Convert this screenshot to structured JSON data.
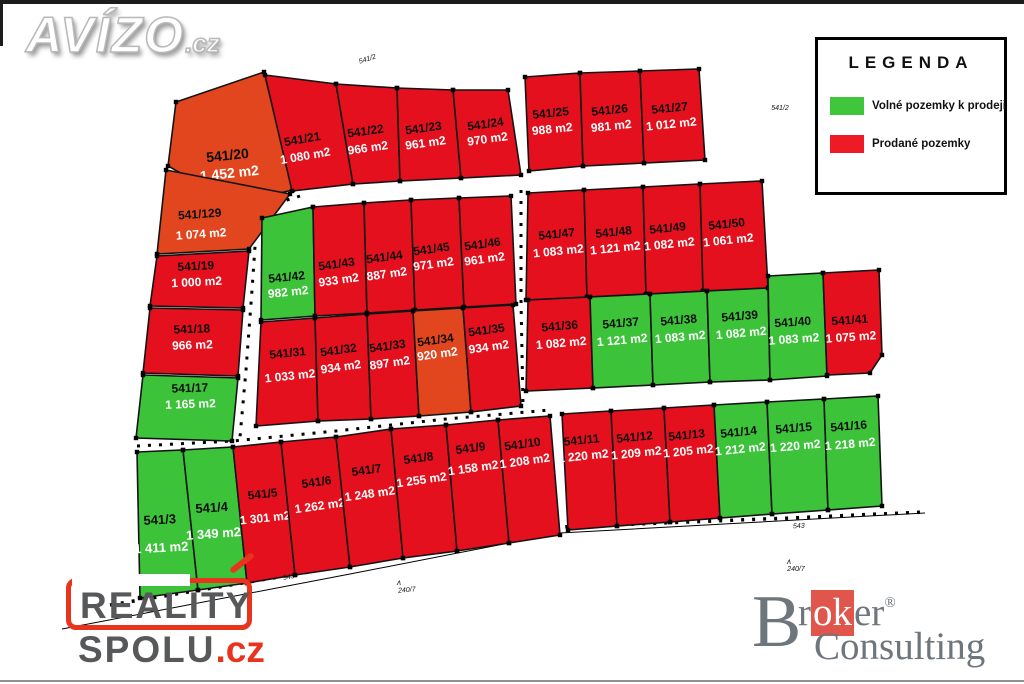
{
  "branding": {
    "avizo": {
      "text": "AVÍZO",
      "suffix": ".cz"
    },
    "reality_spolu": {
      "line1": "REALITY",
      "line2": "SPOLU",
      "suffix": ".cz"
    },
    "broker": {
      "b": "B",
      "pre": "r",
      "ok": "ok",
      "post": "er",
      "reg": "®",
      "line2": "Consulting"
    }
  },
  "legend": {
    "title": "LEGENDA",
    "items": [
      {
        "label": "Volné pozemky k prodeji",
        "color": "#3fc63c",
        "status": "available"
      },
      {
        "label": "Prodané pozemky",
        "color": "#ed1b24",
        "status": "sold"
      }
    ]
  },
  "colors": {
    "sold": "#e5101e",
    "sold_alt": "#e2461e",
    "available": "#3cc33a",
    "stroke": "#141414",
    "number_text": "#0d0d0d",
    "area_text": "#ffffff"
  },
  "parcels": [
    {
      "n": "541/20",
      "a": "1 452 m2",
      "s": "sold",
      "alt": true,
      "pts": "176,102 264,72 293,190 234,203 168,166",
      "lx": 228,
      "ly": 160,
      "dy": 18,
      "rot": -6,
      "fs": 14
    },
    {
      "n": "541/129",
      "a": "1 074 m2",
      "s": "sold",
      "alt": true,
      "pts": "166,170 290,194 249,249 157,254",
      "lx": 200,
      "ly": 218,
      "dy": 20,
      "rot": -4,
      "fs": 12
    },
    {
      "n": "541/19",
      "a": "1 000 m2",
      "s": "sold",
      "pts": "157,256 249,251 243,308 150,306",
      "lx": 196,
      "ly": 270,
      "dy": 16,
      "rot": -3,
      "fs": 12
    },
    {
      "n": "541/18",
      "a": "966 m2",
      "s": "sold",
      "pts": "150,308 243,310 238,376 143,373",
      "lx": 192,
      "ly": 333,
      "dy": 16,
      "rot": -2,
      "fs": 12
    },
    {
      "n": "541/17",
      "a": "1 165 m2",
      "s": "available",
      "pts": "143,375 238,378 232,441 136,438",
      "lx": 190,
      "ly": 392,
      "dy": 16,
      "rot": -2,
      "fs": 12
    },
    {
      "n": "541/21",
      "a": "1 080 m2",
      "s": "sold",
      "pts": "265,75 336,84 353,184 292,191",
      "lx": 303,
      "ly": 143,
      "dy": 17,
      "rot": -10,
      "fs": 12
    },
    {
      "n": "541/22",
      "a": "966 m2",
      "s": "sold",
      "pts": "336,84 397,88 400,181 353,184",
      "lx": 366,
      "ly": 135,
      "dy": 17,
      "rot": -8,
      "fs": 12
    },
    {
      "n": "541/23",
      "a": "961 m2",
      "s": "sold",
      "pts": "397,88 453,90 461,178 400,181",
      "lx": 424,
      "ly": 132,
      "dy": 15,
      "rot": -8,
      "fs": 12
    },
    {
      "n": "541/24",
      "a": "970 m2",
      "s": "sold",
      "pts": "453,90 508,90 521,175 461,178",
      "lx": 486,
      "ly": 128,
      "dy": 15,
      "rot": -8,
      "fs": 12
    },
    {
      "n": "541/25",
      "a": "988 m2",
      "s": "sold",
      "pts": "525,77 580,73 583,166 529,171",
      "lx": 551,
      "ly": 117,
      "dy": 16,
      "rot": -6,
      "fs": 12
    },
    {
      "n": "541/26",
      "a": "981 m2",
      "s": "sold",
      "pts": "580,73 640,71 644,163 583,166",
      "lx": 610,
      "ly": 114,
      "dy": 16,
      "rot": -6,
      "fs": 12
    },
    {
      "n": "541/27",
      "a": "1 012 m2",
      "s": "sold",
      "pts": "640,71 699,69 705,160 644,163",
      "lx": 670,
      "ly": 112,
      "dy": 16,
      "rot": -6,
      "fs": 12
    },
    {
      "n": "541/42",
      "a": "982 m2",
      "s": "available",
      "pts": "262,218 313,207 315,316 261,320",
      "lx": 287,
      "ly": 281,
      "dy": 15,
      "rot": -6,
      "fs": 12
    },
    {
      "n": "541/43",
      "a": "933 m2",
      "s": "sold",
      "pts": "313,207 364,203 367,313 315,316",
      "lx": 337,
      "ly": 268,
      "dy": 16,
      "rot": -8,
      "fs": 12
    },
    {
      "n": "541/44",
      "a": "887 m2",
      "s": "sold",
      "pts": "364,203 411,200 415,310 367,313",
      "lx": 385,
      "ly": 261,
      "dy": 17,
      "rot": -8,
      "fs": 12
    },
    {
      "n": "541/45",
      "a": "971 m2",
      "s": "sold",
      "pts": "411,200 459,198 464,307 415,310",
      "lx": 432,
      "ly": 253,
      "dy": 15,
      "rot": -8,
      "fs": 12
    },
    {
      "n": "541/46",
      "a": "961 m2",
      "s": "sold",
      "pts": "459,198 511,196 516,304 464,307",
      "lx": 483,
      "ly": 248,
      "dy": 15,
      "rot": -8,
      "fs": 12
    },
    {
      "n": "541/47",
      "a": "1 083 m2",
      "s": "sold",
      "pts": "528,193 584,190 587,297 526,300",
      "lx": 557,
      "ly": 238,
      "dy": 17,
      "rot": -6,
      "fs": 12
    },
    {
      "n": "541/48",
      "a": "1 121 m2",
      "s": "sold",
      "pts": "584,190 643,187 646,294 587,297",
      "lx": 614,
      "ly": 236,
      "dy": 16,
      "rot": -6,
      "fs": 12
    },
    {
      "n": "541/49",
      "a": "1 082 m2",
      "s": "sold",
      "pts": "643,187 700,184 703,291 646,294",
      "lx": 668,
      "ly": 232,
      "dy": 16,
      "rot": -6,
      "fs": 12
    },
    {
      "n": "541/50",
      "a": "1 061 m2",
      "s": "sold",
      "pts": "700,184 762,181 768,288 703,291",
      "lx": 727,
      "ly": 228,
      "dy": 16,
      "rot": -6,
      "fs": 12
    },
    {
      "n": "541/31",
      "a": "1 033 m2",
      "s": "sold",
      "pts": "261,322 315,318 318,421 256,426",
      "lx": 288,
      "ly": 357,
      "dy": 23,
      "rot": -6,
      "fs": 12
    },
    {
      "n": "541/32",
      "a": "934 m2",
      "s": "sold",
      "pts": "315,318 367,314 371,419 318,421",
      "lx": 339,
      "ly": 354,
      "dy": 17,
      "rot": -8,
      "fs": 12
    },
    {
      "n": "541/33",
      "a": "897 m2",
      "s": "sold",
      "pts": "367,314 413,311 419,416 371,419",
      "lx": 388,
      "ly": 350,
      "dy": 17,
      "rot": -8,
      "fs": 12
    },
    {
      "n": "541/34",
      "a": "920 m2",
      "s": "sold",
      "alt": true,
      "pts": "413,311 463,308 471,412 419,416",
      "lx": 436,
      "ly": 344,
      "dy": 14,
      "rot": -8,
      "fs": 12
    },
    {
      "n": "541/35",
      "a": "934 m2",
      "s": "sold",
      "pts": "463,308 513,305 521,406 471,412",
      "lx": 487,
      "ly": 334,
      "dy": 17,
      "rot": -8,
      "fs": 12
    },
    {
      "n": "541/36",
      "a": "1 082 m2",
      "s": "sold",
      "pts": "528,300 590,297 593,388 526,391",
      "lx": 560,
      "ly": 330,
      "dy": 17,
      "rot": -5,
      "fs": 12
    },
    {
      "n": "541/37",
      "a": "1 121 m2",
      "s": "available",
      "pts": "590,297 650,294 653,385 593,388",
      "lx": 621,
      "ly": 327,
      "dy": 17,
      "rot": -5,
      "fs": 12
    },
    {
      "n": "541/38",
      "a": "1 083 m2",
      "s": "available",
      "pts": "650,294 707,291 710,382 653,385",
      "lx": 679,
      "ly": 324,
      "dy": 17,
      "rot": -5,
      "fs": 12
    },
    {
      "n": "541/39",
      "a": "1 082 m2",
      "s": "available",
      "pts": "707,291 768,288 770,380 710,382",
      "lx": 740,
      "ly": 320,
      "dy": 17,
      "rot": -5,
      "fs": 12
    },
    {
      "n": "541/40",
      "a": "1 083 m2",
      "s": "available",
      "pts": "768,276 823,273 827,376 770,380",
      "lx": 793,
      "ly": 326,
      "dy": 17,
      "rot": -4,
      "fs": 12
    },
    {
      "n": "541/41",
      "a": "1 075 m2",
      "s": "sold",
      "pts": "823,273 879,270 882,355 870,373 827,375",
      "lx": 850,
      "ly": 324,
      "dy": 17,
      "rot": -4,
      "fs": 12
    },
    {
      "n": "541/3",
      "a": "1 411 m2",
      "s": "available",
      "pts": "137,452 183,450 198,590 140,598",
      "lx": 160,
      "ly": 524,
      "dy": 28,
      "rot": -3,
      "fs": 13
    },
    {
      "n": "541/4",
      "a": "1 349 m2",
      "s": "available",
      "pts": "183,450 233,447 247,583 198,590",
      "lx": 212,
      "ly": 512,
      "dy": 26,
      "rot": -4,
      "fs": 13
    },
    {
      "n": "541/5",
      "a": "1 301 m2",
      "s": "sold",
      "pts": "233,447 281,442 295,575 247,583",
      "lx": 263,
      "ly": 498,
      "dy": 24,
      "rot": -6,
      "fs": 12
    },
    {
      "n": "541/6",
      "a": "1 262 m2",
      "s": "sold",
      "pts": "281,442 336,437 350,567 295,575",
      "lx": 317,
      "ly": 486,
      "dy": 24,
      "rot": -8,
      "fs": 12
    },
    {
      "n": "541/7",
      "a": "1 248 m2",
      "s": "sold",
      "pts": "336,437 391,429 403,558 350,567",
      "lx": 367,
      "ly": 474,
      "dy": 24,
      "rot": -8,
      "fs": 12
    },
    {
      "n": "541/8",
      "a": "1 255 m2",
      "s": "sold",
      "pts": "391,429 446,425 457,551 403,558",
      "lx": 419,
      "ly": 462,
      "dy": 22,
      "rot": -8,
      "fs": 12
    },
    {
      "n": "541/9",
      "a": "1 158 m2",
      "s": "sold",
      "pts": "446,425 498,420 509,543 457,551",
      "lx": 471,
      "ly": 452,
      "dy": 20,
      "rot": -8,
      "fs": 12
    },
    {
      "n": "541/10",
      "a": "1 208 m2",
      "s": "sold",
      "pts": "498,420 550,416 560,535 509,543",
      "lx": 523,
      "ly": 448,
      "dy": 17,
      "rot": -8,
      "fs": 12
    },
    {
      "n": "541/11",
      "a": "1 220 m2",
      "s": "sold",
      "pts": "562,414 611,411 617,526 568,530",
      "lx": 582,
      "ly": 444,
      "dy": 16,
      "rot": -6,
      "fs": 12
    },
    {
      "n": "541/12",
      "a": "1 209 m2",
      "s": "sold",
      "pts": "611,411 664,408 670,522 617,526",
      "lx": 635,
      "ly": 441,
      "dy": 16,
      "rot": -6,
      "fs": 12
    },
    {
      "n": "541/13",
      "a": "1 205 m2",
      "s": "sold",
      "pts": "664,408 714,405 720,518 670,522",
      "lx": 687,
      "ly": 439,
      "dy": 16,
      "rot": -6,
      "fs": 12
    },
    {
      "n": "541/14",
      "a": "1 212 m2",
      "s": "available",
      "pts": "714,405 767,402 772,514 720,518",
      "lx": 739,
      "ly": 436,
      "dy": 17,
      "rot": -6,
      "fs": 12
    },
    {
      "n": "541/15",
      "a": "1 220 m2",
      "s": "available",
      "pts": "767,402 824,399 828,510 772,514",
      "lx": 794,
      "ly": 432,
      "dy": 18,
      "rot": -5,
      "fs": 12
    },
    {
      "n": "541/16",
      "a": "1 218 m2",
      "s": "available",
      "pts": "824,399 878,396 882,506 828,510",
      "lx": 849,
      "ly": 430,
      "dy": 18,
      "rot": -5,
      "fs": 12
    }
  ],
  "map_labels": [
    {
      "text": "541/2",
      "x": 368,
      "y": 61,
      "rot": -18,
      "fs": 7
    },
    {
      "text": "541/2",
      "x": 780,
      "y": 110,
      "rot": 0,
      "fs": 7
    },
    {
      "text": "543",
      "x": 289,
      "y": 579,
      "rot": -10,
      "fs": 7
    },
    {
      "text": "ʌ",
      "x": 399,
      "y": 585,
      "rot": 0,
      "fs": 8
    },
    {
      "text": "240/7",
      "x": 407,
      "y": 592,
      "rot": -5,
      "fs": 7
    },
    {
      "text": "543",
      "x": 799,
      "y": 528,
      "rot": -4,
      "fs": 7
    },
    {
      "text": "ʌ",
      "x": 789,
      "y": 564,
      "rot": 0,
      "fs": 8
    },
    {
      "text": "240/7",
      "x": 796,
      "y": 571,
      "rot": 0,
      "fs": 7
    }
  ],
  "survey_lines": [
    {
      "points": "110,605 345,566 560,527 790,518 925,512",
      "dash": true,
      "w": 3.5
    },
    {
      "points": "62,629 350,574 560,533 925,513",
      "dash": false,
      "w": 1
    },
    {
      "points": "300,196 268,206 256,232 252,290 246,370 240,437",
      "dash": true,
      "w": 3
    },
    {
      "points": "521,190 521,300 523,405",
      "dash": true,
      "w": 3
    },
    {
      "points": "137,446 233,441 336,431 446,419 550,410",
      "dash": true,
      "w": 3
    }
  ]
}
